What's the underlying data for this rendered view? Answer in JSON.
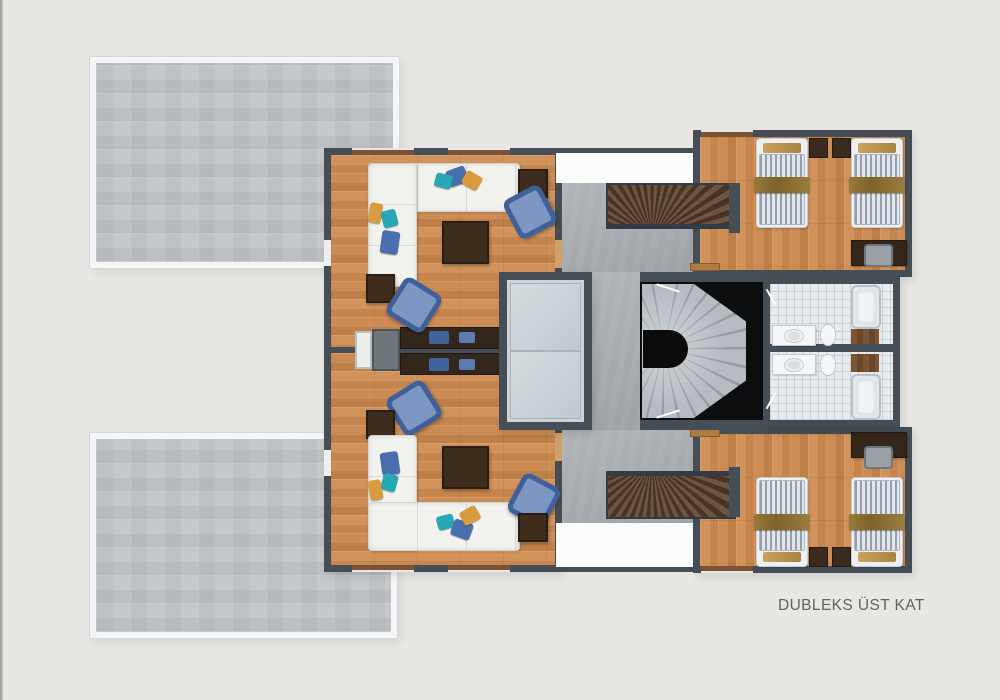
{
  "page": {
    "label": "DUBLEKS ÜST KAT"
  },
  "palette": {
    "background": "#e9e7e4",
    "wall": "#454e57",
    "wood_floor": "#c98a52",
    "terrace_tile": "#c6c9cb",
    "concrete": "#a8acb0",
    "elevator_panel": "#ccd3d8",
    "void_black": "#0c0d0e",
    "spiral_step": "#b6bcc2",
    "sofa_white": "#f2f2ef",
    "armchair_blue": "#40609b",
    "pillow_teal": "#28a7b5",
    "pillow_blue": "#4a6fae",
    "pillow_orange": "#d89b3d",
    "table_brown": "#3e2d1c",
    "bed_stripe": "#939eb0",
    "bed_throw": "#7d6429",
    "label_text": "#5f6266"
  },
  "rooms": [
    {
      "name": "terrace-top"
    },
    {
      "name": "terrace-bottom"
    },
    {
      "name": "living-room-upper"
    },
    {
      "name": "living-room-lower"
    },
    {
      "name": "corridor-upper"
    },
    {
      "name": "corridor-lower"
    },
    {
      "name": "duplex-stairs-upper"
    },
    {
      "name": "duplex-stairs-lower"
    },
    {
      "name": "elevator"
    },
    {
      "name": "spiral-staircase"
    },
    {
      "name": "bedroom-upper"
    },
    {
      "name": "bedroom-lower"
    },
    {
      "name": "bathroom-upper"
    },
    {
      "name": "bathroom-lower"
    }
  ]
}
